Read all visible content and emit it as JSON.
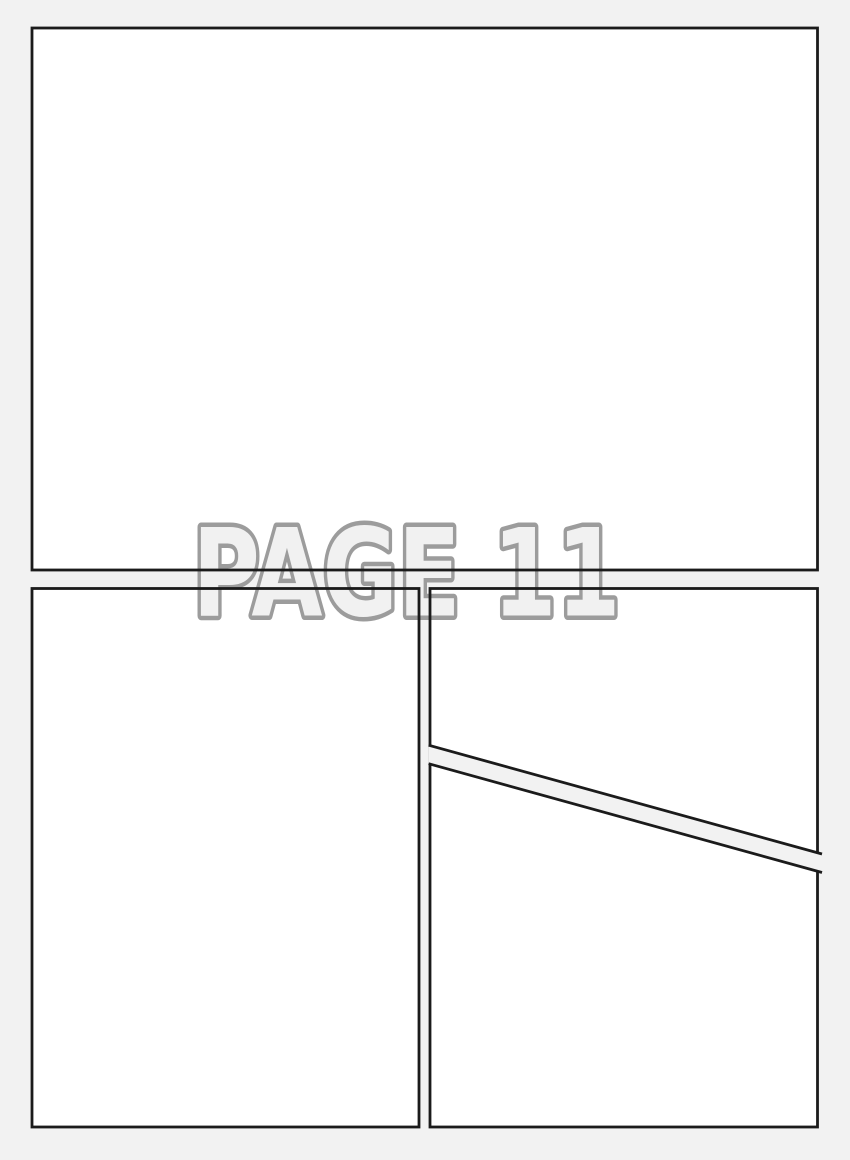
{
  "watermark": {
    "label": "PAGE 11"
  },
  "colors": {
    "page_bg": "#f2f2f2",
    "panel_fill": "#ffffff",
    "panel_border": "#1b1b1b",
    "watermark_fill": "#f1f1f1",
    "watermark_outline": "#9c9c9c"
  },
  "panels": [
    {
      "id": "panel-1",
      "position": "top full-width"
    },
    {
      "id": "panel-2",
      "position": "bottom left"
    },
    {
      "id": "panel-3",
      "position": "bottom right, above diagonal gutter"
    },
    {
      "id": "panel-4",
      "position": "bottom right, below diagonal gutter"
    }
  ]
}
